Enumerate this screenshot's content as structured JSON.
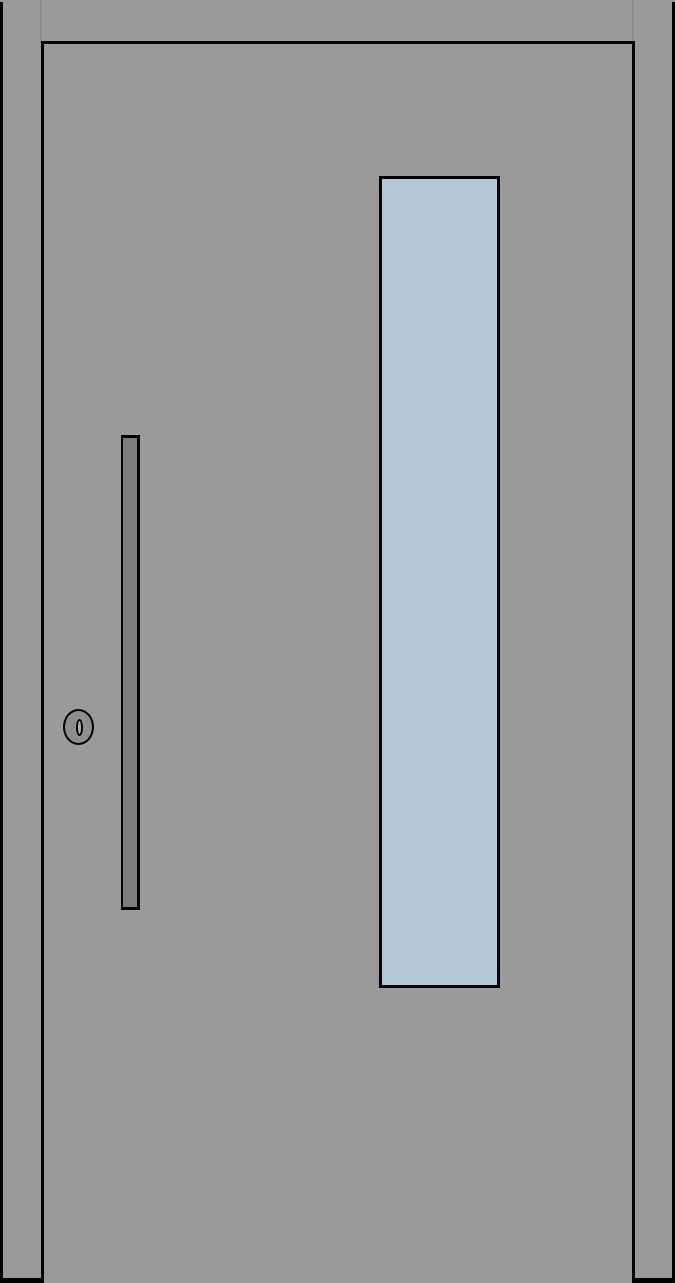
{
  "scene": {
    "description": "Front elevation drawing of a modern single entry door with a tall vertical glass panel, vertical pull handle bar and lock cylinder",
    "elements": {
      "frame": "Door frame",
      "frame_joint_left": "Frame joint seam (left, head-to-jamb)",
      "frame_joint_right": "Frame joint seam (right, head-to-jamb)",
      "leaf": "Door leaf",
      "glass": "Vertical glazing panel",
      "handle": "Vertical pull handle bar",
      "lock": "Lock cylinder",
      "keyhole": "Keyhole slot"
    }
  },
  "colors": {
    "frame": "#9a9a9a",
    "leaf": "#9a9a9a",
    "outline": "#000000",
    "joint": "#8b8b8b",
    "glass": "#b2c8d6",
    "handle": "#7d7d7d",
    "lock_body": "#8e8e8e",
    "keyhole_slot": "#b3b3b3"
  }
}
